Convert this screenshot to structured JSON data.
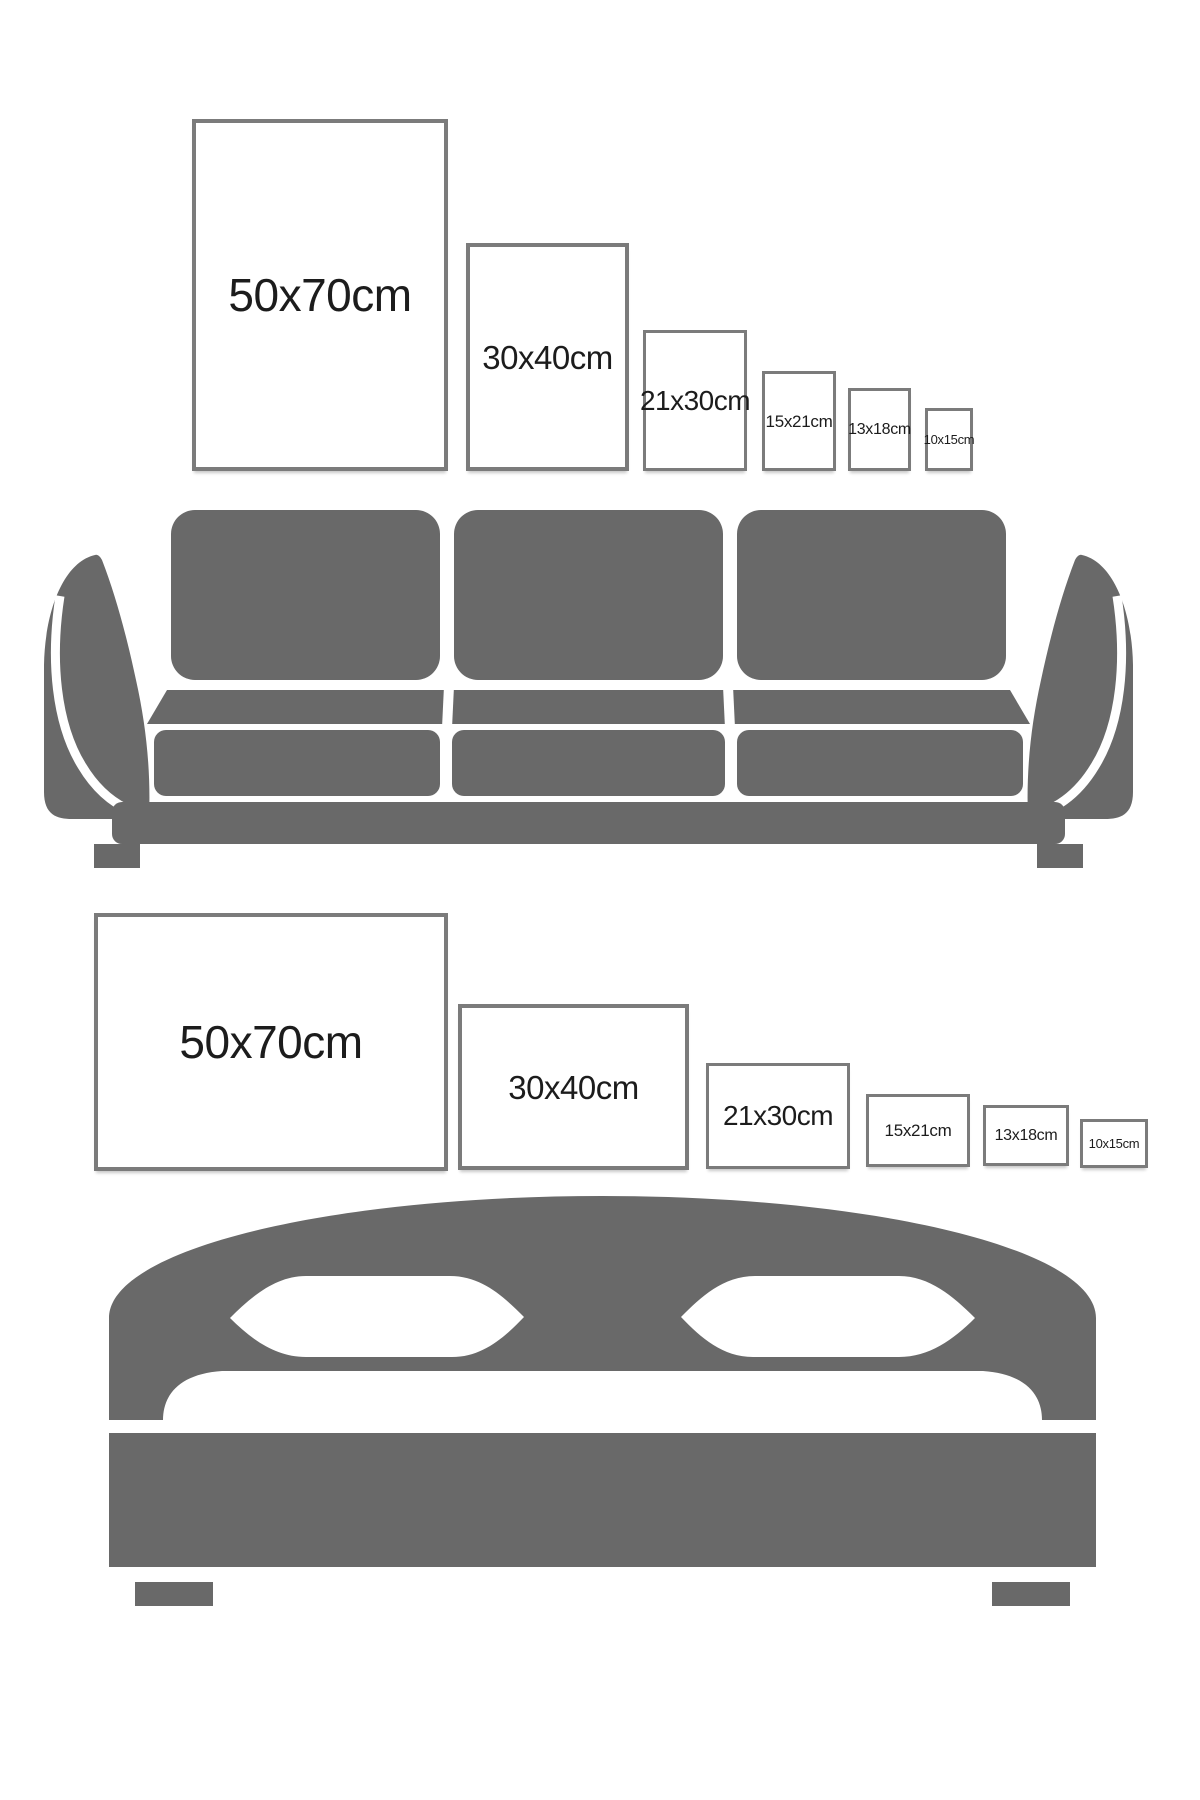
{
  "colors": {
    "background": "#ffffff",
    "furniture_gray": "#696969",
    "frame_border": "#7b7b7b",
    "label_text": "#1c1c1c"
  },
  "sofa_scene": {
    "illustration": "three-seat-sofa",
    "frames": [
      {
        "size": "50x70",
        "orientation": "portrait",
        "label": "50x70cm"
      },
      {
        "size": "30x40",
        "orientation": "portrait",
        "label": "30x40cm"
      },
      {
        "size": "21x30",
        "orientation": "portrait",
        "label": "21x30cm"
      },
      {
        "size": "15x21",
        "orientation": "portrait",
        "label": "15x21cm"
      },
      {
        "size": "13x18",
        "orientation": "portrait",
        "label": "13x18cm"
      },
      {
        "size": "10x15",
        "orientation": "portrait",
        "label": "10x15cm"
      }
    ]
  },
  "bed_scene": {
    "illustration": "double-bed",
    "frames": [
      {
        "size": "50x70",
        "orientation": "landscape",
        "label": "50x70cm"
      },
      {
        "size": "30x40",
        "orientation": "landscape",
        "label": "30x40cm"
      },
      {
        "size": "21x30",
        "orientation": "landscape",
        "label": "21x30cm"
      },
      {
        "size": "15x21",
        "orientation": "landscape",
        "label": "15x21cm"
      },
      {
        "size": "13x18",
        "orientation": "landscape",
        "label": "13x18cm"
      },
      {
        "size": "10x15",
        "orientation": "landscape",
        "label": "10x15cm"
      }
    ]
  }
}
